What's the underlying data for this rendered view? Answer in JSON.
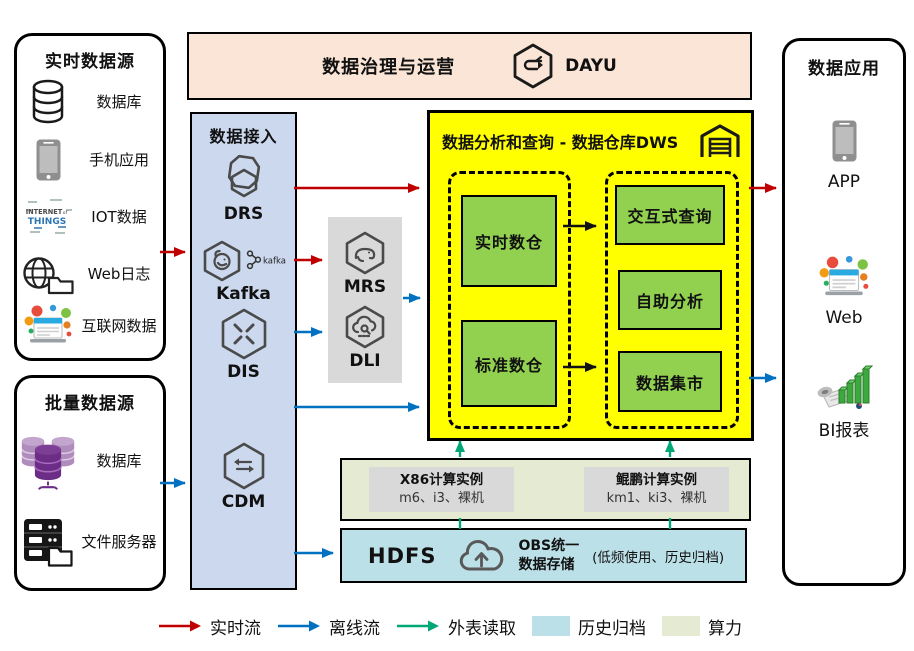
{
  "colors": {
    "realtime_flow": "#C00000",
    "offline_flow": "#0070C0",
    "external_read": "#00A878",
    "history_archive_fill": "#BCE0E8",
    "compute_fill": "#E4EBD2",
    "warehouse_fill": "#FFFF00",
    "module_fill": "#92D050",
    "ingestion_fill": "#CBD8EE",
    "governance_fill": "#FBE5D6",
    "processing_fill": "#D9D9D9"
  },
  "governance": {
    "title": "数据治理与运营",
    "product": "DAYU"
  },
  "realtime_sources": {
    "title": "实时数据源",
    "items": [
      {
        "label": "数据库"
      },
      {
        "label": "手机应用"
      },
      {
        "label": "IOT数据"
      },
      {
        "label": "Web日志"
      },
      {
        "label": "互联网数据"
      }
    ],
    "iot_words": {
      "w1": "INTERNET",
      "w2": "of",
      "w3": "THINGS"
    }
  },
  "batch_sources": {
    "title": "批量数据源",
    "items": [
      {
        "label": "数据库"
      },
      {
        "label": "文件服务器"
      }
    ]
  },
  "ingestion": {
    "title": "数据接入",
    "services": [
      "DRS",
      "Kafka",
      "DIS",
      "CDM"
    ],
    "kafka_logo_text": "kafka"
  },
  "processing": {
    "services": [
      "MRS",
      "DLI"
    ]
  },
  "warehouse": {
    "title": "数据分析和查询 - 数据仓库DWS",
    "layers": [
      "实时数仓",
      "标准数仓"
    ],
    "services": [
      "交互式查询",
      "自助分析",
      "数据集市"
    ]
  },
  "compute": {
    "instances": [
      {
        "title": "X86计算实例",
        "detail": "m6、i3、裸机"
      },
      {
        "title": "鲲鹏计算实例",
        "detail": "km1、ki3、裸机"
      }
    ]
  },
  "storage": {
    "hdfs_label": "HDFS",
    "obs_line1": "OBS统一",
    "obs_line2": "数据存储",
    "note": "(低频使用、历史归档)"
  },
  "applications": {
    "title": "数据应用",
    "items": [
      {
        "label": "APP"
      },
      {
        "label": "Web"
      },
      {
        "label": "BI报表"
      }
    ]
  },
  "legend": {
    "flows": [
      {
        "label": "实时流",
        "color": "#C00000"
      },
      {
        "label": "离线流",
        "color": "#0070C0"
      },
      {
        "label": "外表读取",
        "color": "#00A878"
      }
    ],
    "swatches": [
      {
        "label": "历史归档",
        "color": "#BCE0E8"
      },
      {
        "label": "算力",
        "color": "#E4EBD2"
      }
    ]
  }
}
